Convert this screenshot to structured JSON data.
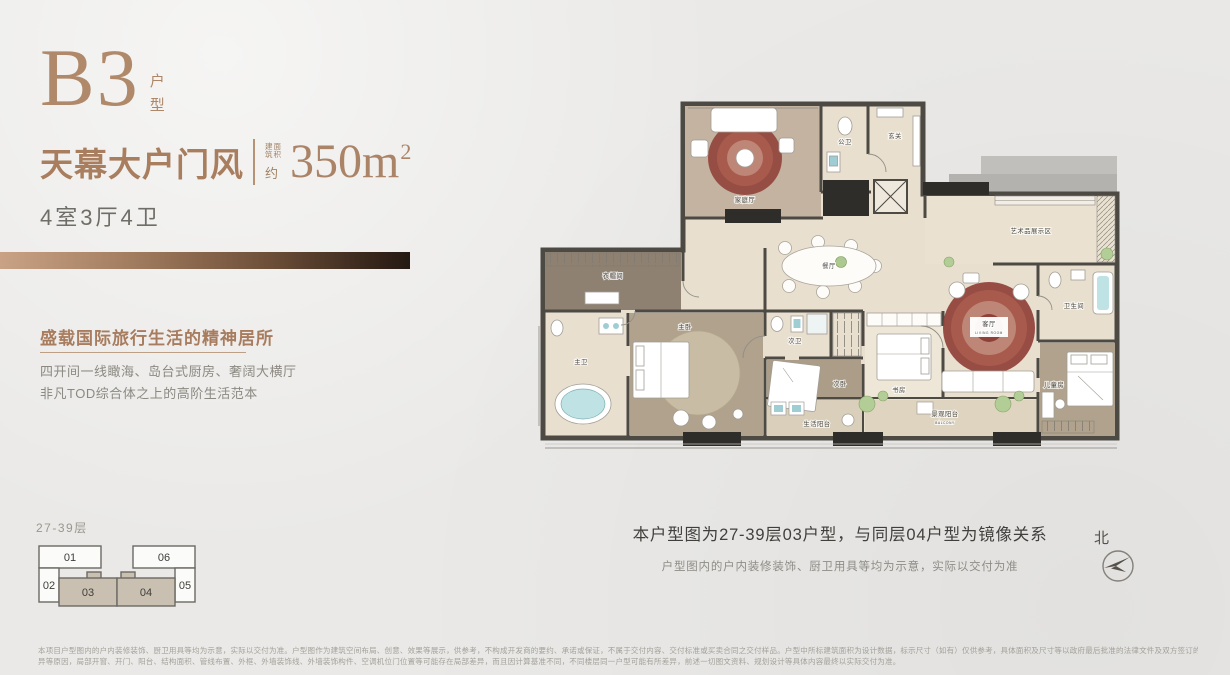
{
  "badge": {
    "code": "B3",
    "suffix": [
      "户",
      "型"
    ]
  },
  "headline": {
    "title": "天幕大户门风",
    "area_tiny": [
      "建面",
      "筑积"
    ],
    "area_approx": "约",
    "area_value": "350m",
    "area_sup": "2"
  },
  "rooms_line": "4室3厅4卫",
  "slogan": {
    "title": "盛载国际旅行生活的精神居所",
    "lines": [
      "四开间一线瞰海、岛台式厨房、奢阔大横厅",
      "非凡TOD综合体之上的高阶生活范本"
    ]
  },
  "keyplan": {
    "floors": "27-39层",
    "units": [
      "01",
      "02",
      "03",
      "04",
      "05",
      "06"
    ],
    "highlighted": [
      "03",
      "04"
    ],
    "highlight_color": "#c9c0b1"
  },
  "floorplan": {
    "rooms": {
      "family": "家庭厅",
      "guest_bath": "公卫",
      "foyer": "玄关",
      "art_display": "艺术品展示区",
      "dining": "餐厅",
      "living": "客厅",
      "living_en": "LIVING ROOM",
      "bathroom": "卫生间",
      "kids": "儿童房",
      "cloakroom": "衣帽间",
      "master_bath": "主卫",
      "master": "主卧",
      "second_bath": "次卫",
      "second_bed": "次卧",
      "study": "书房",
      "service_balcony": "生活阳台",
      "view_balcony": "景观阳台",
      "view_balcony_en": "BALCONY"
    },
    "accent_rug": "#8f4038",
    "wall_color": "#4d4a44"
  },
  "caption": {
    "main": "本户型图为27-39层03户型，与同层04户型为镜像关系",
    "sub": "户型图内的户内装修装饰、厨卫用具等均为示意，实际以交付为准"
  },
  "compass": {
    "label": "北"
  },
  "disclaimer": {
    "line1": "本项目户型图内的户内装修装饰、厨卫用具等均为示意，实际以交付为准。户型图作为建筑空间布局、创意、效果等展示，供参考，不构成开发商的要约、承诺或保证，不属于交付内容、交付标准或买卖合同之交付样品。户型中所标建筑面积为设计数据，标示尺寸（如有）仅供参考，具体面积及尺寸等以政府最后批准的法律文件及双方签订的买卖合同为准。相同户型因建筑立面、楼层差",
    "line2": "异等原因，局部开窗、开门、阳台、结构面积、管线布置、外框、外墙装饰线、外墙装饰构件、空调机位门位置等可能存在局部差异，而且因计算基准不同，不同楼层同一户型可能有所差异，前述一切图文资料、规划设计等具体内容最终以实际交付为准。"
  }
}
